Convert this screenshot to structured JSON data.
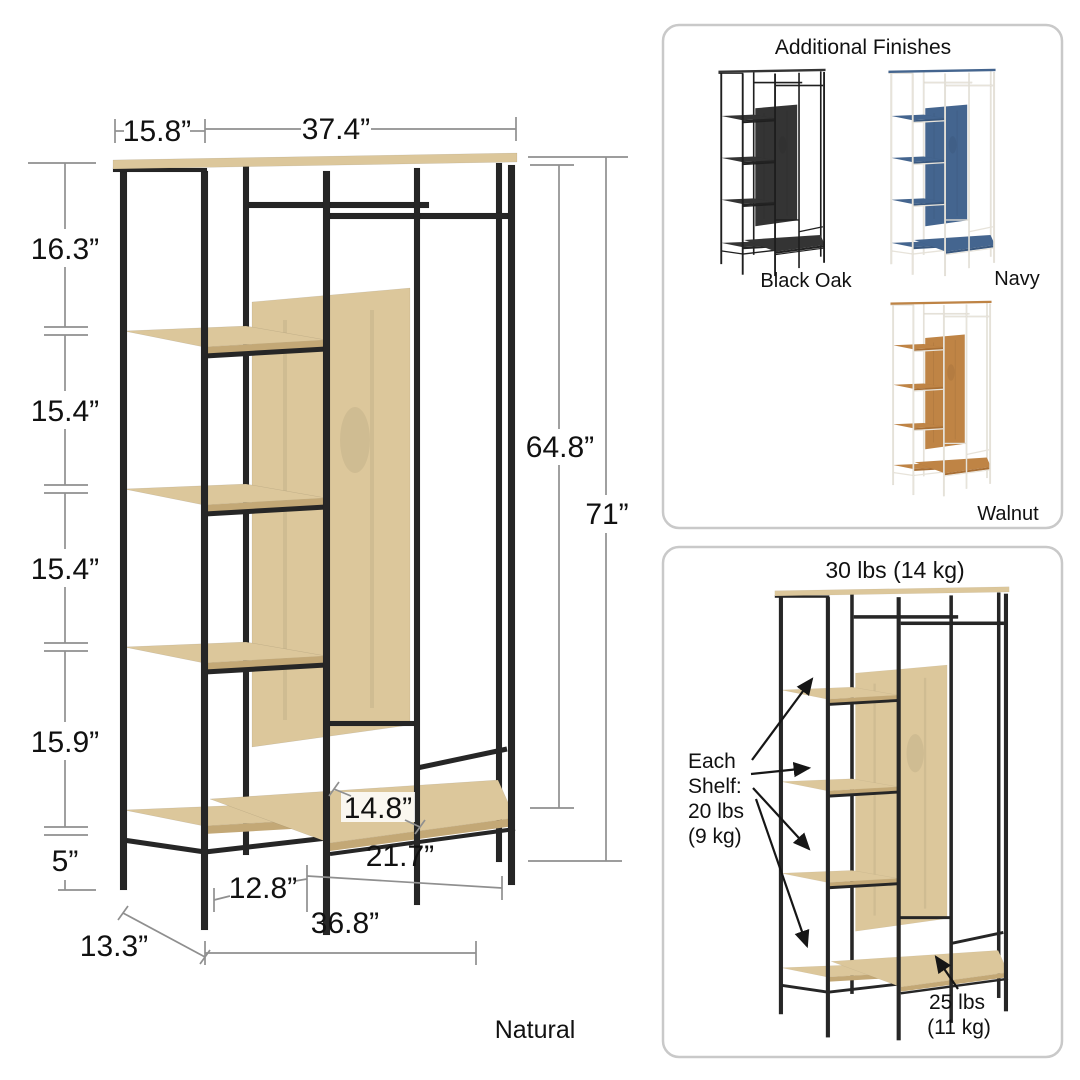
{
  "product": {
    "finish_label": "Natural"
  },
  "dimensions": {
    "shelf_tower_width": "15.8”",
    "hanging_section_width": "37.4”",
    "left_gaps": [
      "16.3”",
      "15.4”",
      "15.4”",
      "15.9”",
      "5”"
    ],
    "interior_height": "64.8”",
    "overall_height": "71”",
    "bottom_shelf_depth": "14.8”",
    "hanging_bottom_width": "21.7”",
    "tower_bottom_width": "12.8”",
    "overall_width": "36.8”",
    "overall_depth": "13.3”"
  },
  "finishes_panel": {
    "title": "Additional Finishes",
    "options": [
      "Black Oak",
      "Navy",
      "Walnut"
    ]
  },
  "capacity_panel": {
    "top_rail_capacity": "30 lbs (14 kg)",
    "shelf_capacity": [
      "Each",
      "Shelf:",
      "20 lbs",
      "(9 kg)"
    ],
    "bottom_shelf_capacity": [
      "25 lbs",
      "(11 kg)"
    ]
  },
  "colors": {
    "frame_black": "#262626",
    "frame_cream": "#e7e3da",
    "wood_natural": "#dcc79b",
    "wood_natural_edge": "#c3a876",
    "wood_walnut": "#bf8445",
    "wood_walnut_edge": "#a86f35",
    "wood_navy": "#44658f",
    "wood_navy_edge": "#3a587e",
    "wood_black_oak": "#343434",
    "wood_black_oak_edge": "#232323",
    "dimension_line": "#8f8f8f",
    "panel_border": "#c9c9c9",
    "text": "#111111"
  }
}
